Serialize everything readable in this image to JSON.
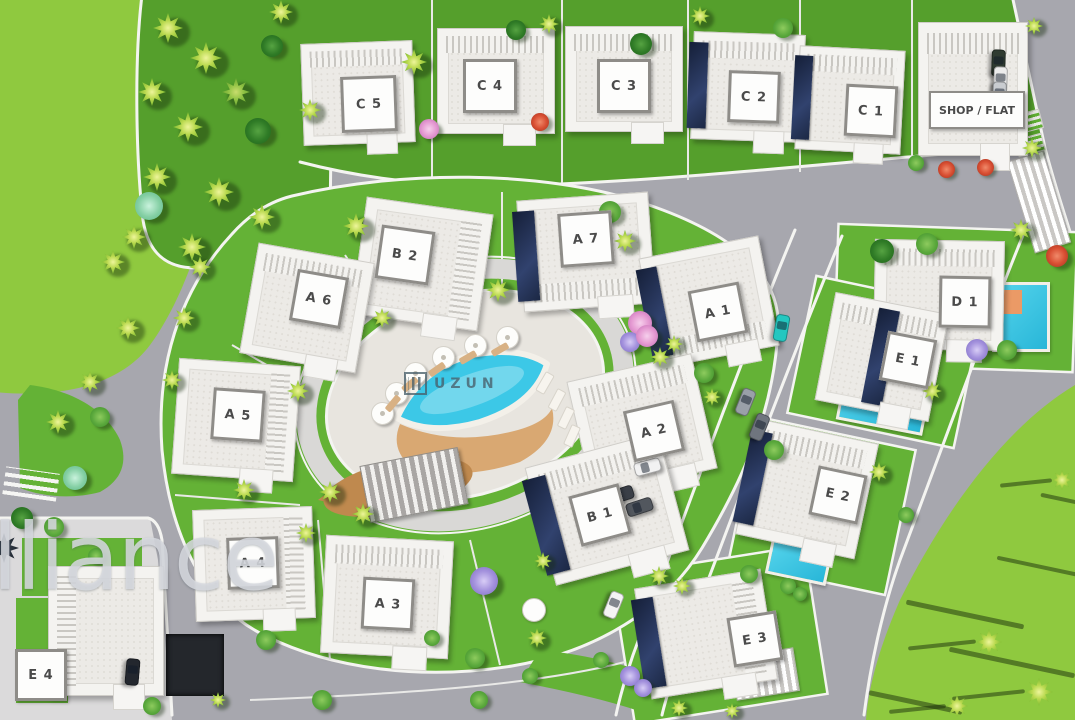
{
  "meta": {
    "description": "Aerial 3D master plan render of a villa development with pool"
  },
  "watermarks": {
    "brand": "alliance",
    "pool_logo": "UZUN"
  },
  "palette": {
    "road": "#a7a7ae",
    "pavement": "#dbdadb",
    "sidewalk": "#f4f4f1",
    "grass": "#64b236",
    "grass_bright": "#8fc93f",
    "plaza": "#e8e5df",
    "pool": "#3cc8e7",
    "deck": "#d9a872",
    "building": "#f4f3f0",
    "solar_panel": "#1c2844",
    "plaque_border": "#8e8c88",
    "label_text": "#4a4a4a"
  },
  "villas": [
    {
      "id": "C5",
      "label": "C 5",
      "x": 302,
      "y": 42,
      "w": 112,
      "h": 102,
      "rot": -2,
      "stripes": "top",
      "panel": null,
      "plaque": {
        "x": 366,
        "y": 101,
        "w": 50,
        "h": 50
      }
    },
    {
      "id": "C4",
      "label": "C 4",
      "x": 437,
      "y": 28,
      "w": 118,
      "h": 106,
      "rot": 0,
      "stripes": "top",
      "panel": null,
      "plaque": {
        "x": 487,
        "y": 83,
        "w": 48,
        "h": 48
      }
    },
    {
      "id": "C3",
      "label": "C 3",
      "x": 565,
      "y": 26,
      "w": 118,
      "h": 106,
      "rot": 0,
      "stripes": "top",
      "panel": null,
      "plaque": {
        "x": 621,
        "y": 83,
        "w": 48,
        "h": 48
      }
    },
    {
      "id": "C2",
      "label": "C 2",
      "x": 692,
      "y": 33,
      "w": 112,
      "h": 108,
      "rot": 2,
      "stripes": "top",
      "panel": "left",
      "plaque": {
        "x": 751,
        "y": 94,
        "w": 46,
        "h": 46
      }
    },
    {
      "id": "C1",
      "label": "C 1",
      "x": 797,
      "y": 48,
      "w": 106,
      "h": 104,
      "rot": 3,
      "stripes": "top",
      "panel": "left",
      "plaque": {
        "x": 868,
        "y": 108,
        "w": 46,
        "h": 46
      }
    },
    {
      "id": "SHOP",
      "label": "SHOP / FLAT",
      "x": 918,
      "y": 22,
      "w": 110,
      "h": 134,
      "rot": 0,
      "stripes": "top",
      "panel": null,
      "plaque": {
        "x": 975,
        "y": 108,
        "w": 92,
        "h": 34,
        "wide": true
      }
    },
    {
      "id": "B2",
      "label": "B 2",
      "x": 358,
      "y": 205,
      "w": 128,
      "h": 118,
      "rot": 8,
      "stripes": "right",
      "panel": null,
      "plaque": {
        "x": 402,
        "y": 252,
        "w": 48,
        "h": 48
      }
    },
    {
      "id": "A7",
      "label": "A 7",
      "x": 520,
      "y": 196,
      "w": 132,
      "h": 112,
      "rot": -4,
      "stripes": "bottom",
      "panel": "left",
      "plaque": {
        "x": 583,
        "y": 236,
        "w": 48,
        "h": 48
      }
    },
    {
      "id": "A6",
      "label": "A 6",
      "x": 248,
      "y": 252,
      "w": 118,
      "h": 112,
      "rot": 10,
      "stripes": "top",
      "panel": null,
      "plaque": {
        "x": 316,
        "y": 296,
        "w": 46,
        "h": 46
      }
    },
    {
      "id": "A1",
      "label": "A 1",
      "x": 648,
      "y": 246,
      "w": 122,
      "h": 112,
      "rot": -11,
      "stripes": "bottom",
      "panel": "left",
      "plaque": {
        "x": 715,
        "y": 309,
        "w": 46,
        "h": 46
      }
    },
    {
      "id": "D1",
      "label": "D 1",
      "x": 874,
      "y": 240,
      "w": 130,
      "h": 110,
      "rot": 1,
      "stripes": "top",
      "panel": null,
      "plaque": {
        "x": 962,
        "y": 299,
        "w": 46,
        "h": 46
      },
      "pool": {
        "x": 992,
        "y": 282,
        "w": 52,
        "h": 64,
        "rot": 0,
        "pad": true
      }
    },
    {
      "id": "E1",
      "label": "E 1",
      "x": 824,
      "y": 302,
      "w": 116,
      "h": 110,
      "rot": 11,
      "stripes": "top",
      "panel": "mid",
      "plaque": {
        "x": 905,
        "y": 357,
        "w": 44,
        "h": 44
      },
      "pool": {
        "x": 840,
        "y": 374,
        "w": 82,
        "h": 48,
        "rot": 11
      }
    },
    {
      "id": "A5",
      "label": "A 5",
      "x": 175,
      "y": 362,
      "w": 122,
      "h": 116,
      "rot": 4,
      "stripes": "right",
      "panel": null,
      "plaque": {
        "x": 235,
        "y": 412,
        "w": 46,
        "h": 46
      }
    },
    {
      "id": "A2",
      "label": "A 2",
      "x": 578,
      "y": 366,
      "w": 128,
      "h": 118,
      "rot": -13,
      "stripes": "top",
      "panel": null,
      "plaque": {
        "x": 651,
        "y": 428,
        "w": 46,
        "h": 46
      }
    },
    {
      "id": "E2",
      "label": "E 2",
      "x": 746,
      "y": 430,
      "w": 122,
      "h": 118,
      "rot": 12,
      "stripes": "top",
      "panel": "left",
      "plaque": {
        "x": 835,
        "y": 492,
        "w": 44,
        "h": 44
      },
      "pool": {
        "x": 768,
        "y": 542,
        "w": 56,
        "h": 32,
        "rot": 12
      }
    },
    {
      "id": "B1",
      "label": "B 1",
      "x": 538,
      "y": 448,
      "w": 138,
      "h": 122,
      "rot": -15,
      "stripes": "top",
      "panel": "left",
      "plaque": {
        "x": 597,
        "y": 512,
        "w": 46,
        "h": 46
      }
    },
    {
      "id": "A4",
      "label": "A 4",
      "x": 194,
      "y": 508,
      "w": 120,
      "h": 112,
      "rot": -2,
      "stripes": "right",
      "panel": null,
      "plaque": {
        "x": 250,
        "y": 560,
        "w": 46,
        "h": 46
      }
    },
    {
      "id": "A3",
      "label": "A 3",
      "x": 323,
      "y": 538,
      "w": 128,
      "h": 118,
      "rot": 3,
      "stripes": "top",
      "panel": null,
      "plaque": {
        "x": 385,
        "y": 601,
        "w": 46,
        "h": 46
      }
    },
    {
      "id": "E3",
      "label": "E 3",
      "x": 642,
      "y": 578,
      "w": 128,
      "h": 112,
      "rot": -9,
      "stripes": "right",
      "panel": "left",
      "plaque": {
        "x": 752,
        "y": 636,
        "w": 44,
        "h": 44
      }
    },
    {
      "id": "E4",
      "label": "E 4",
      "x": 48,
      "y": 566,
      "w": 116,
      "h": 130,
      "rot": 0,
      "stripes": "left",
      "panel": null,
      "plaque": {
        "x": 38,
        "y": 672,
        "w": 46,
        "h": 46
      }
    }
  ],
  "trees": [
    [
      168,
      28,
      30,
      "p"
    ],
    [
      206,
      58,
      32,
      "p"
    ],
    [
      152,
      92,
      28,
      "p"
    ],
    [
      236,
      92,
      28,
      "pd"
    ],
    [
      188,
      127,
      30,
      "p"
    ],
    [
      258,
      131,
      26,
      "bd"
    ],
    [
      157,
      177,
      28,
      "p"
    ],
    [
      149,
      206,
      28,
      "bt"
    ],
    [
      219,
      192,
      30,
      "p"
    ],
    [
      262,
      217,
      26,
      "p"
    ],
    [
      134,
      237,
      24,
      "p"
    ],
    [
      192,
      247,
      28,
      "p"
    ],
    [
      281,
      12,
      24,
      "p"
    ],
    [
      272,
      46,
      22,
      "bd"
    ],
    [
      310,
      110,
      22,
      "p"
    ],
    [
      414,
      62,
      26,
      "p"
    ],
    [
      429,
      129,
      20,
      "pk"
    ],
    [
      540,
      122,
      18,
      "rd"
    ],
    [
      516,
      30,
      20,
      "bd"
    ],
    [
      549,
      24,
      20,
      "p"
    ],
    [
      641,
      44,
      22,
      "bd"
    ],
    [
      700,
      16,
      20,
      "p"
    ],
    [
      783,
      28,
      20,
      "b"
    ],
    [
      916,
      163,
      16,
      "b"
    ],
    [
      946,
      169,
      17,
      "rd"
    ],
    [
      985,
      167,
      17,
      "rd"
    ],
    [
      1032,
      148,
      20,
      "p"
    ],
    [
      1034,
      26,
      18,
      "p"
    ],
    [
      356,
      226,
      26,
      "p"
    ],
    [
      498,
      290,
      24,
      "p"
    ],
    [
      610,
      212,
      22,
      "b"
    ],
    [
      625,
      241,
      22,
      "p"
    ],
    [
      640,
      323,
      24,
      "pk"
    ],
    [
      630,
      342,
      20,
      "pu"
    ],
    [
      382,
      318,
      20,
      "p"
    ],
    [
      298,
      391,
      22,
      "p"
    ],
    [
      244,
      490,
      22,
      "p"
    ],
    [
      330,
      492,
      22,
      "p"
    ],
    [
      306,
      533,
      20,
      "p"
    ],
    [
      363,
      514,
      22,
      "p"
    ],
    [
      484,
      581,
      28,
      "pu"
    ],
    [
      537,
      638,
      20,
      "p"
    ],
    [
      543,
      561,
      18,
      "p"
    ],
    [
      475,
      658,
      20,
      "b"
    ],
    [
      479,
      700,
      18,
      "b"
    ],
    [
      432,
      638,
      16,
      "b"
    ],
    [
      647,
      336,
      22,
      "pk"
    ],
    [
      660,
      357,
      20,
      "p"
    ],
    [
      674,
      344,
      18,
      "p"
    ],
    [
      704,
      373,
      20,
      "b"
    ],
    [
      712,
      397,
      18,
      "p"
    ],
    [
      774,
      450,
      20,
      "b"
    ],
    [
      882,
      251,
      24,
      "bd"
    ],
    [
      927,
      244,
      22,
      "b"
    ],
    [
      1021,
      230,
      22,
      "p"
    ],
    [
      1057,
      256,
      22,
      "rd"
    ],
    [
      977,
      350,
      22,
      "pu"
    ],
    [
      1007,
      350,
      20,
      "b"
    ],
    [
      932,
      391,
      20,
      "p"
    ],
    [
      879,
      472,
      20,
      "p"
    ],
    [
      906,
      515,
      16,
      "b"
    ],
    [
      659,
      576,
      20,
      "p"
    ],
    [
      682,
      586,
      18,
      "p"
    ],
    [
      749,
      574,
      18,
      "b"
    ],
    [
      788,
      586,
      16,
      "b"
    ],
    [
      800,
      594,
      14,
      "b"
    ],
    [
      630,
      676,
      20,
      "pu"
    ],
    [
      643,
      688,
      18,
      "pu"
    ],
    [
      679,
      708,
      18,
      "p"
    ],
    [
      732,
      711,
      16,
      "p"
    ],
    [
      601,
      660,
      16,
      "b"
    ],
    [
      530,
      676,
      16,
      "b"
    ],
    [
      989,
      642,
      26,
      "pf"
    ],
    [
      1039,
      692,
      28,
      "pf"
    ],
    [
      957,
      706,
      22,
      "pf"
    ],
    [
      1062,
      480,
      20,
      "pf"
    ],
    [
      113,
      262,
      24,
      "p"
    ],
    [
      128,
      328,
      24,
      "p"
    ],
    [
      90,
      382,
      22,
      "p"
    ],
    [
      58,
      422,
      24,
      "p"
    ],
    [
      100,
      417,
      20,
      "b"
    ],
    [
      75,
      478,
      24,
      "bt"
    ],
    [
      184,
      318,
      22,
      "p"
    ],
    [
      200,
      267,
      22,
      "p"
    ],
    [
      172,
      380,
      20,
      "p"
    ],
    [
      22,
      518,
      22,
      "bd"
    ],
    [
      54,
      527,
      20,
      "b"
    ],
    [
      266,
      640,
      20,
      "b"
    ],
    [
      322,
      700,
      20,
      "b"
    ],
    [
      152,
      706,
      18,
      "b"
    ],
    [
      96,
      556,
      16,
      "b"
    ],
    [
      218,
      700,
      16,
      "p"
    ],
    [
      4,
      548,
      30,
      "ps"
    ]
  ],
  "cars": [
    [
      780,
      327,
      100,
      "#25c7c0"
    ],
    [
      744,
      401,
      112,
      "#9aa0a8"
    ],
    [
      758,
      426,
      112,
      "#6f757e"
    ],
    [
      646,
      466,
      -15,
      "#f2f2f2"
    ],
    [
      619,
      494,
      -18,
      "#3a3f47"
    ],
    [
      638,
      506,
      -18,
      "#52575e"
    ],
    [
      612,
      604,
      112,
      "#f4f4f4"
    ],
    [
      131,
      671,
      95,
      "#23272e"
    ],
    [
      997,
      62,
      92,
      "#2f3b31"
    ],
    [
      999,
      79,
      92,
      "#ececec"
    ],
    [
      998,
      94,
      92,
      "#c9ccd0"
    ]
  ],
  "umbrellas": [
    [
      506,
      336
    ],
    [
      474,
      344
    ],
    [
      442,
      356
    ],
    [
      414,
      372
    ],
    [
      395,
      392
    ],
    [
      381,
      412
    ]
  ],
  "pads": [
    [
      500,
      349,
      -30
    ],
    [
      468,
      357,
      -30
    ],
    [
      437,
      369,
      -35
    ],
    [
      410,
      384,
      -40
    ],
    [
      393,
      403,
      -50
    ]
  ],
  "lounges": [
    [
      544,
      382,
      -60
    ],
    [
      556,
      399,
      -62
    ],
    [
      565,
      417,
      -64
    ],
    [
      571,
      435,
      -66
    ]
  ],
  "structures": [
    [
      "striped",
      972,
      24,
      42,
      40,
      0
    ],
    [
      "striped",
      1020,
      154,
      36,
      94,
      -17
    ],
    [
      "striped",
      733,
      652,
      62,
      42,
      -9
    ],
    [
      "pergola",
      364,
      456,
      98,
      56,
      -11
    ],
    [
      "dark",
      166,
      634,
      58,
      62,
      0
    ],
    [
      "grassgrid",
      984,
      33,
      26,
      20,
      0
    ],
    [
      "grassgrid",
      1012,
      112,
      28,
      18,
      -15
    ],
    [
      "grassgrid",
      1016,
      136,
      26,
      16,
      -15
    ],
    [
      "crosswalk",
      4,
      470,
      54,
      28,
      8
    ],
    [
      "shadow",
      905,
      612,
      120,
      5,
      12
    ],
    [
      "shadow",
      948,
      660,
      128,
      5,
      12
    ],
    [
      "shadow",
      996,
      566,
      100,
      4,
      12
    ],
    [
      "shadow",
      868,
      700,
      95,
      5,
      12
    ],
    [
      "shadow",
      1040,
      500,
      70,
      4,
      12
    ],
    [
      "table",
      522,
      598,
      22,
      22,
      0
    ]
  ]
}
